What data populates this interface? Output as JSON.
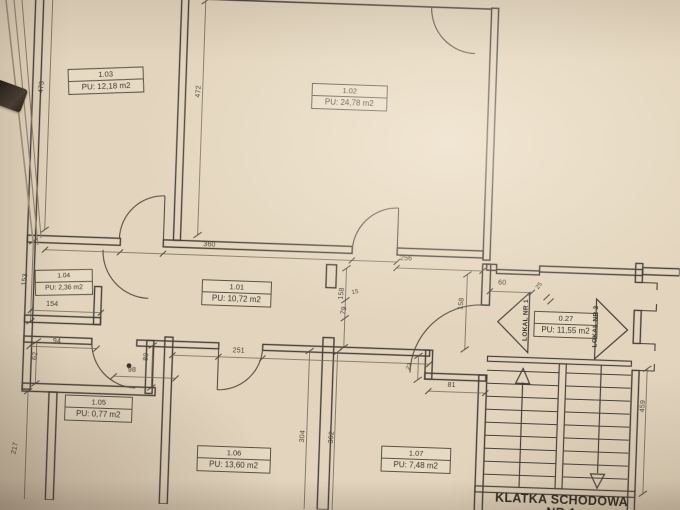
{
  "rooms": {
    "r103": {
      "num": "1.03",
      "area": "PU: 12,18 m2"
    },
    "r102": {
      "num": "1.02",
      "area": "PU: 24,78 m2"
    },
    "r101": {
      "num": "1.01",
      "area": "PU: 10,72 m2"
    },
    "r104": {
      "num": "1.04",
      "area": "PU: 2,36 m2"
    },
    "r105": {
      "num": "1.05",
      "area": "PU: 0,77 m2"
    },
    "r106": {
      "num": "1.06",
      "area": "PU: 13,60 m2"
    },
    "r107": {
      "num": "1.07",
      "area": "PU: 7,48 m2"
    },
    "r027": {
      "num": "0.27",
      "area": "PU: 11,55 m2"
    }
  },
  "annotations": {
    "lokal1": "LOKAL NR 1",
    "lokal2": "LOKAL NR 2",
    "staircase_line1": "KLATKA SCHODOWA",
    "staircase_line2": "NR 1"
  },
  "dimensions": {
    "d473": "473",
    "d472": "472",
    "d360": "360",
    "d256": "256",
    "d153": "153",
    "d154": "154",
    "d94": "94",
    "d62": "62",
    "d98": "98",
    "d89": "89",
    "d158a": "158",
    "d15": "15",
    "d79": "79",
    "d158b": "158",
    "d251": "251",
    "d23": "23",
    "d81": "81",
    "d304": "304",
    "d302": "302",
    "d217": "217",
    "d60": "60",
    "d25": "25",
    "d459": "459"
  },
  "colors": {
    "paper": "#e3d5bd",
    "ink": "#46403a"
  }
}
